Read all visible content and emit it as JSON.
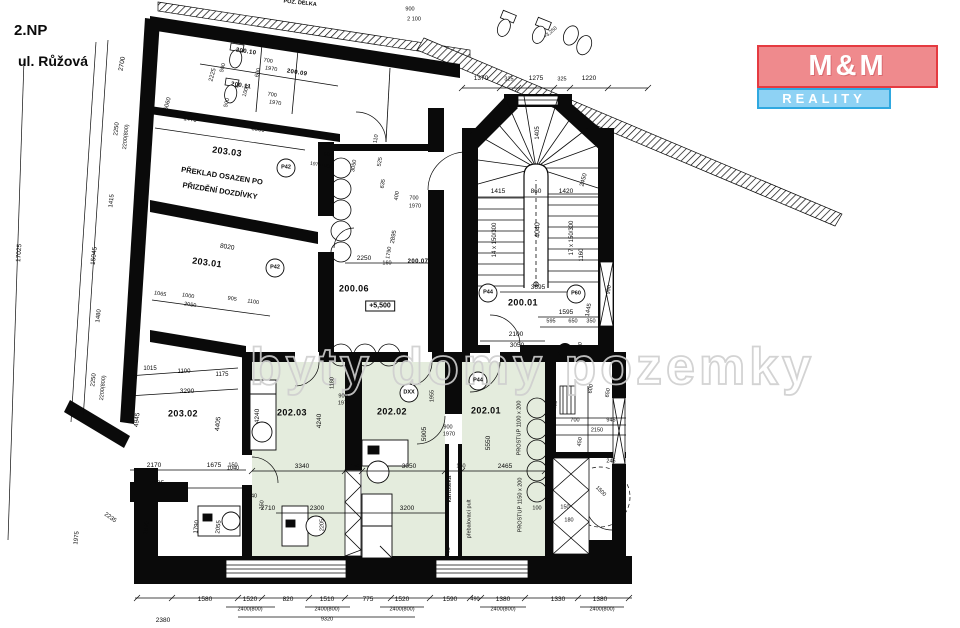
{
  "header": {
    "floor": "2.NP",
    "street": "ul. Růžová"
  },
  "logo": {
    "top": "M&M",
    "bottom": "REALITY"
  },
  "watermark": "byty domy pozemky",
  "colors": {
    "logo_pink": "#ef8a8d",
    "logo_red": "#e53a40",
    "logo_blue": "#8ed2f4",
    "logo_blue_border": "#2fa8e0",
    "room_green": "#e4ecdd",
    "watermark_gray": "#cfcfcf",
    "wall_black": "#0a0a0a"
  },
  "plan": {
    "labels": [
      {
        "t": "203.03",
        "x": 227,
        "y": 152,
        "r": 8,
        "s": 9,
        "k": "room"
      },
      {
        "t": "203.01",
        "x": 207,
        "y": 263,
        "r": 8,
        "s": 9,
        "k": "room"
      },
      {
        "t": "203.02",
        "x": 183,
        "y": 414,
        "s": 9,
        "k": "room"
      },
      {
        "t": "202.03",
        "x": 292,
        "y": 413,
        "s": 9,
        "k": "room"
      },
      {
        "t": "202.02",
        "x": 392,
        "y": 412,
        "s": 9,
        "k": "room"
      },
      {
        "t": "202.01",
        "x": 486,
        "y": 411,
        "s": 9,
        "k": "room"
      },
      {
        "t": "200.06",
        "x": 354,
        "y": 289,
        "s": 9,
        "k": "room"
      },
      {
        "t": "200.01",
        "x": 523,
        "y": 303,
        "s": 9,
        "k": "room"
      },
      {
        "t": "200.10",
        "x": 246,
        "y": 52,
        "r": 9,
        "s": 6,
        "k": "room"
      },
      {
        "t": "200.11",
        "x": 241,
        "y": 86,
        "r": 9,
        "s": 6,
        "k": "room"
      },
      {
        "t": "200.09",
        "x": 297,
        "y": 73,
        "r": 9,
        "s": 6,
        "k": "room"
      },
      {
        "t": "200.07",
        "x": 418,
        "y": 262,
        "s": 6,
        "k": "room"
      },
      {
        "t": "PŘEKLAD OSAZEN PO",
        "x": 222,
        "y": 176,
        "r": 9,
        "s": 7.5,
        "b": 1,
        "k": "note"
      },
      {
        "t": "PŘIZDĚNÍ DOZDÍVKY",
        "x": 220,
        "y": 191,
        "r": 9,
        "s": 7.5,
        "b": 1,
        "k": "note"
      },
      {
        "t": "+5,500",
        "x": 380,
        "y": 306,
        "s": 7,
        "b": 1,
        "k": "box"
      },
      {
        "t": "P42",
        "x": 286,
        "y": 168,
        "s": 5.5,
        "b": 1,
        "k": "tag"
      },
      {
        "t": "P42",
        "x": 275,
        "y": 268,
        "s": 5.5,
        "b": 1,
        "k": "tag"
      },
      {
        "t": "P44",
        "x": 488,
        "y": 293,
        "s": 5.5,
        "b": 1,
        "k": "tag"
      },
      {
        "t": "P44",
        "x": 478,
        "y": 381,
        "s": 5.5,
        "b": 1,
        "k": "tag"
      },
      {
        "t": "P60",
        "x": 576,
        "y": 294,
        "s": 5.5,
        "b": 1,
        "k": "tag"
      },
      {
        "t": "DXX",
        "x": 409,
        "y": 393,
        "s": 5.5,
        "b": 1,
        "k": "tag"
      },
      {
        "t": "14 x 150/300",
        "x": 495,
        "y": 240,
        "r": -90,
        "s": 6
      },
      {
        "t": "17 x 150/300",
        "x": 572,
        "y": 238,
        "r": -90,
        "s": 6
      },
      {
        "t": "4040",
        "x": 538,
        "y": 230,
        "r": -90,
        "s": 7
      },
      {
        "t": "1405",
        "x": 538,
        "y": 133,
        "r": -90,
        "s": 6
      },
      {
        "t": "1415",
        "x": 498,
        "y": 192,
        "s": 6.5
      },
      {
        "t": "860",
        "x": 536,
        "y": 192,
        "s": 6.5
      },
      {
        "t": "1420",
        "x": 566,
        "y": 192,
        "s": 6.5
      },
      {
        "t": "2450",
        "x": 584,
        "y": 180,
        "r": -75,
        "s": 6
      },
      {
        "t": "1160",
        "x": 582,
        "y": 255,
        "r": -90,
        "s": 6
      },
      {
        "t": "1370",
        "x": 481,
        "y": 79,
        "s": 6.5
      },
      {
        "t": "325",
        "x": 509,
        "y": 80,
        "s": 5.5
      },
      {
        "t": "1275",
        "x": 536,
        "y": 79,
        "s": 6.5
      },
      {
        "t": "325",
        "x": 562,
        "y": 80,
        "s": 5.5
      },
      {
        "t": "1220",
        "x": 589,
        "y": 79,
        "s": 6.5
      },
      {
        "t": "3695",
        "x": 538,
        "y": 288,
        "s": 6.5
      },
      {
        "t": "1595",
        "x": 566,
        "y": 313,
        "s": 6.5
      },
      {
        "t": "595",
        "x": 551,
        "y": 322,
        "s": 5.5
      },
      {
        "t": "650",
        "x": 573,
        "y": 322,
        "s": 5.5
      },
      {
        "t": "350",
        "x": 591,
        "y": 322,
        "s": 5.5
      },
      {
        "t": "2100",
        "x": 516,
        "y": 335,
        "s": 6.5
      },
      {
        "t": "3050",
        "x": 517,
        "y": 346,
        "s": 6.5
      },
      {
        "t": "1445",
        "x": 589,
        "y": 310,
        "r": -80,
        "s": 6
      },
      {
        "t": "570",
        "x": 581,
        "y": 347,
        "r": -80,
        "s": 5.5
      },
      {
        "t": "990",
        "x": 610,
        "y": 290,
        "r": -80,
        "s": 5.5
      },
      {
        "t": "2250",
        "x": 364,
        "y": 259,
        "s": 6.5
      },
      {
        "t": "160",
        "x": 387,
        "y": 264,
        "s": 5.5
      },
      {
        "t": "2895",
        "x": 394,
        "y": 237,
        "r": -80,
        "s": 6
      },
      {
        "t": "1790",
        "x": 390,
        "y": 253,
        "r": -80,
        "s": 5.5
      },
      {
        "t": "700",
        "x": 414,
        "y": 199,
        "s": 5.5
      },
      {
        "t": "1970",
        "x": 415,
        "y": 207,
        "s": 5.5
      },
      {
        "t": "400",
        "x": 398,
        "y": 196,
        "r": -80,
        "s": 5.5
      },
      {
        "t": "525",
        "x": 381,
        "y": 162,
        "r": -80,
        "s": 5.5
      },
      {
        "t": "635",
        "x": 384,
        "y": 184,
        "r": -80,
        "s": 5.5
      },
      {
        "t": "110",
        "x": 377,
        "y": 139,
        "r": -80,
        "s": 5.5
      },
      {
        "t": "3050",
        "x": 355,
        "y": 166,
        "r": -80,
        "s": 5.5
      },
      {
        "t": "900",
        "x": 328,
        "y": 156,
        "r": 9,
        "s": 5.5
      },
      {
        "t": "1970+900",
        "x": 321,
        "y": 166,
        "r": 9,
        "s": 5
      },
      {
        "t": "3550",
        "x": 258,
        "y": 130,
        "r": 9,
        "s": 6
      },
      {
        "t": "1470",
        "x": 190,
        "y": 120,
        "r": 9,
        "s": 6
      },
      {
        "t": "2225",
        "x": 213,
        "y": 75,
        "r": -75,
        "s": 6
      },
      {
        "t": "1000",
        "x": 247,
        "y": 91,
        "r": -75,
        "s": 5.5
      },
      {
        "t": "5060",
        "x": 168,
        "y": 104,
        "r": -75,
        "s": 6
      },
      {
        "t": "2700",
        "x": 123,
        "y": 64,
        "r": -80,
        "s": 6.5
      },
      {
        "t": "700",
        "x": 268,
        "y": 62,
        "r": 9,
        "s": 5.5
      },
      {
        "t": "1970",
        "x": 271,
        "y": 70,
        "r": 9,
        "s": 5.5
      },
      {
        "t": "500",
        "x": 224,
        "y": 68,
        "r": -75,
        "s": 5.5
      },
      {
        "t": "700",
        "x": 272,
        "y": 96,
        "r": 9,
        "s": 5.5
      },
      {
        "t": "1970",
        "x": 275,
        "y": 104,
        "r": 9,
        "s": 5.5
      },
      {
        "t": "500",
        "x": 228,
        "y": 103,
        "r": -75,
        "s": 5.5
      },
      {
        "t": "600",
        "x": 259,
        "y": 73,
        "r": -75,
        "s": 5.5
      },
      {
        "t": "1065",
        "x": 160,
        "y": 295,
        "r": 9,
        "s": 5.5
      },
      {
        "t": "1000",
        "x": 188,
        "y": 297,
        "r": 9,
        "s": 5.5
      },
      {
        "t": "905",
        "x": 232,
        "y": 300,
        "r": 9,
        "s": 5.5
      },
      {
        "t": "1100",
        "x": 253,
        "y": 303,
        "r": 9,
        "s": 5.5
      },
      {
        "t": "2050",
        "x": 190,
        "y": 306,
        "r": 9,
        "s": 5.5
      },
      {
        "t": "8020",
        "x": 227,
        "y": 248,
        "r": 9,
        "s": 6.5
      },
      {
        "t": "17025",
        "x": 20,
        "y": 253,
        "r": -86,
        "s": 6.5
      },
      {
        "t": "15045",
        "x": 95,
        "y": 256,
        "r": -84,
        "s": 6.5
      },
      {
        "t": "1480",
        "x": 99,
        "y": 316,
        "r": -84,
        "s": 6
      },
      {
        "t": "2250",
        "x": 117,
        "y": 129,
        "r": -84,
        "s": 6
      },
      {
        "t": "2200(800)",
        "x": 127,
        "y": 137,
        "r": -84,
        "s": 5.5
      },
      {
        "t": "2250",
        "x": 94,
        "y": 380,
        "r": -84,
        "s": 6
      },
      {
        "t": "2200(800)",
        "x": 104,
        "y": 388,
        "r": -84,
        "s": 5.5
      },
      {
        "t": "1415",
        "x": 112,
        "y": 201,
        "r": -84,
        "s": 6
      },
      {
        "t": "1975",
        "x": 77,
        "y": 538,
        "r": -84,
        "s": 6
      },
      {
        "t": "2380",
        "x": 163,
        "y": 621,
        "s": 6.5
      },
      {
        "t": "1690",
        "x": 147,
        "y": 528,
        "r": -84,
        "s": 6
      },
      {
        "t": "2235",
        "x": 110,
        "y": 518,
        "r": 35,
        "s": 6
      },
      {
        "t": "1015",
        "x": 150,
        "y": 369,
        "s": 6
      },
      {
        "t": "1100",
        "x": 184,
        "y": 372,
        "s": 6
      },
      {
        "t": "1175",
        "x": 222,
        "y": 375,
        "s": 6
      },
      {
        "t": "3290",
        "x": 187,
        "y": 392,
        "s": 6.5
      },
      {
        "t": "4945",
        "x": 138,
        "y": 420,
        "r": -84,
        "s": 6.5
      },
      {
        "t": "4405",
        "x": 219,
        "y": 424,
        "r": -84,
        "s": 6.5
      },
      {
        "t": "2170",
        "x": 154,
        "y": 466,
        "s": 6.5
      },
      {
        "t": "1675",
        "x": 214,
        "y": 466,
        "s": 6.5
      },
      {
        "t": "150",
        "x": 233,
        "y": 466,
        "s": 5.5
      },
      {
        "t": "2185",
        "x": 157,
        "y": 484,
        "s": 6.5
      },
      {
        "t": "2710",
        "x": 268,
        "y": 509,
        "s": 6.5
      },
      {
        "t": "1040",
        "x": 251,
        "y": 497,
        "s": 5.5
      },
      {
        "t": "1040",
        "x": 233,
        "y": 469,
        "s": 5.5
      },
      {
        "t": "150",
        "x": 263,
        "y": 505,
        "r": -84,
        "s": 5.5
      },
      {
        "t": "1790",
        "x": 197,
        "y": 527,
        "r": -84,
        "s": 6
      },
      {
        "t": "2055",
        "x": 219,
        "y": 527,
        "r": -84,
        "s": 6
      },
      {
        "t": "4240",
        "x": 258,
        "y": 416,
        "r": -90,
        "s": 6.5
      },
      {
        "t": "4240",
        "x": 320,
        "y": 421,
        "r": -90,
        "s": 6.5
      },
      {
        "t": "1180",
        "x": 333,
        "y": 383,
        "r": -90,
        "s": 5.5
      },
      {
        "t": "900",
        "x": 343,
        "y": 397,
        "s": 5.5
      },
      {
        "t": "1970",
        "x": 344,
        "y": 404,
        "s": 5.5
      },
      {
        "t": "3340",
        "x": 302,
        "y": 467,
        "s": 6.5
      },
      {
        "t": "150",
        "x": 355,
        "y": 467,
        "s": 5.5
      },
      {
        "t": "3050",
        "x": 409,
        "y": 467,
        "s": 6.5
      },
      {
        "t": "150",
        "x": 461,
        "y": 467,
        "s": 5.5
      },
      {
        "t": "2465",
        "x": 505,
        "y": 467,
        "s": 6.5
      },
      {
        "t": "2300",
        "x": 317,
        "y": 509,
        "s": 6.5
      },
      {
        "t": "2205",
        "x": 323,
        "y": 525,
        "r": -90,
        "s": 5.5
      },
      {
        "t": "3200",
        "x": 407,
        "y": 509,
        "s": 6.5
      },
      {
        "t": "5905",
        "x": 425,
        "y": 434,
        "r": -90,
        "s": 6.5
      },
      {
        "t": "1955",
        "x": 433,
        "y": 396,
        "r": -90,
        "s": 5.5
      },
      {
        "t": "900",
        "x": 448,
        "y": 428,
        "s": 5.5
      },
      {
        "t": "1970",
        "x": 449,
        "y": 435,
        "s": 5.5
      },
      {
        "t": "5550",
        "x": 489,
        "y": 443,
        "r": -90,
        "s": 6.5
      },
      {
        "t": "kartotéka",
        "x": 450,
        "y": 489,
        "r": -90,
        "s": 6.5
      },
      {
        "t": "přebalovací pult",
        "x": 470,
        "y": 519,
        "r": -90,
        "s": 5.5
      },
      {
        "t": "PROSTUP 1100 x 200",
        "x": 520,
        "y": 428,
        "r": -90,
        "s": 5.5
      },
      {
        "t": "PROSTUP 1150 x 200",
        "x": 521,
        "y": 505,
        "r": -90,
        "s": 5.5
      },
      {
        "t": "100",
        "x": 537,
        "y": 509,
        "s": 5.5
      },
      {
        "t": "355",
        "x": 449,
        "y": 552,
        "r": -80,
        "s": 5.5
      },
      {
        "t": "700",
        "x": 575,
        "y": 421,
        "s": 5.5
      },
      {
        "t": "945",
        "x": 611,
        "y": 421,
        "s": 5.5
      },
      {
        "t": "2150",
        "x": 597,
        "y": 431,
        "s": 5.5
      },
      {
        "t": "450",
        "x": 581,
        "y": 442,
        "r": -80,
        "s": 5.5
      },
      {
        "t": "245",
        "x": 611,
        "y": 462,
        "s": 5.5
      },
      {
        "t": "1500",
        "x": 600,
        "y": 492,
        "r": 45,
        "s": 5.5
      },
      {
        "t": "2200",
        "x": 556,
        "y": 407,
        "r": -80,
        "s": 5.5
      },
      {
        "t": "650",
        "x": 609,
        "y": 393,
        "r": -80,
        "s": 5.5
      },
      {
        "t": "600",
        "x": 592,
        "y": 389,
        "r": -80,
        "s": 5.5
      },
      {
        "t": "150",
        "x": 565,
        "y": 508,
        "s": 5.5
      },
      {
        "t": "180",
        "x": 569,
        "y": 521,
        "s": 5.5
      },
      {
        "t": "1580",
        "x": 205,
        "y": 600,
        "s": 6.5
      },
      {
        "t": "1520",
        "x": 250,
        "y": 600,
        "s": 6.5
      },
      {
        "t": "820",
        "x": 288,
        "y": 600,
        "s": 6.5
      },
      {
        "t": "1510",
        "x": 327,
        "y": 600,
        "s": 6.5
      },
      {
        "t": "775",
        "x": 368,
        "y": 600,
        "s": 6.5
      },
      {
        "t": "1520",
        "x": 402,
        "y": 600,
        "s": 6.5
      },
      {
        "t": "1590",
        "x": 450,
        "y": 600,
        "s": 6.5
      },
      {
        "t": "490",
        "x": 475,
        "y": 600,
        "s": 5.5
      },
      {
        "t": "1380",
        "x": 503,
        "y": 600,
        "s": 6.5
      },
      {
        "t": "1330",
        "x": 558,
        "y": 600,
        "s": 6.5
      },
      {
        "t": "1380",
        "x": 600,
        "y": 600,
        "s": 6.5
      },
      {
        "t": "2400(800)",
        "x": 250,
        "y": 610,
        "s": 5.5
      },
      {
        "t": "2400(800)",
        "x": 327,
        "y": 610,
        "s": 5.5
      },
      {
        "t": "2400(800)",
        "x": 402,
        "y": 610,
        "s": 5.5
      },
      {
        "t": "2400(800)",
        "x": 503,
        "y": 610,
        "s": 5.5
      },
      {
        "t": "2400(800)",
        "x": 602,
        "y": 610,
        "s": 5.5
      },
      {
        "t": "9320",
        "x": 327,
        "y": 620,
        "s": 5.5
      },
      {
        "t": "900",
        "x": 410,
        "y": 10,
        "s": 5.5
      },
      {
        "t": "2 100",
        "x": 414,
        "y": 20,
        "s": 5.5
      },
      {
        "t": "+3,250",
        "x": 551,
        "y": 33,
        "r": -40,
        "s": 5
      },
      {
        "t": "POZ. DÉLKA",
        "x": 300,
        "y": 4,
        "r": 6,
        "s": 5.5,
        "b": 1
      }
    ]
  }
}
